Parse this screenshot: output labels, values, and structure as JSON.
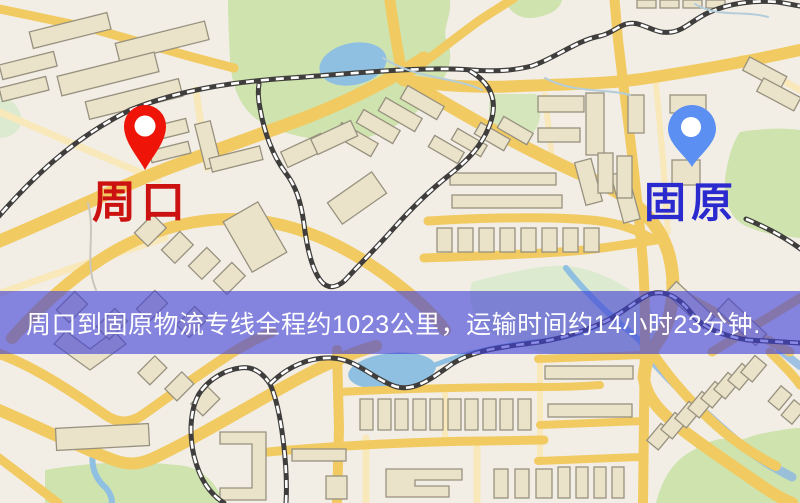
{
  "map": {
    "origin": {
      "name": "周口",
      "pin_color": "#ee1408",
      "label_color": "#cc1111"
    },
    "destination": {
      "name": "固原",
      "pin_color": "#5b8ff2",
      "label_color": "#2a2ace"
    }
  },
  "banner": {
    "text": "周口到固原物流专线全程约1023公里，运输时间约14小时23分钟.",
    "background": "rgba(64,64,214,0.62)",
    "text_color": "#ffffff"
  },
  "route": {
    "distance_text": "约1023公里",
    "duration_text": "约14小时23分钟"
  }
}
